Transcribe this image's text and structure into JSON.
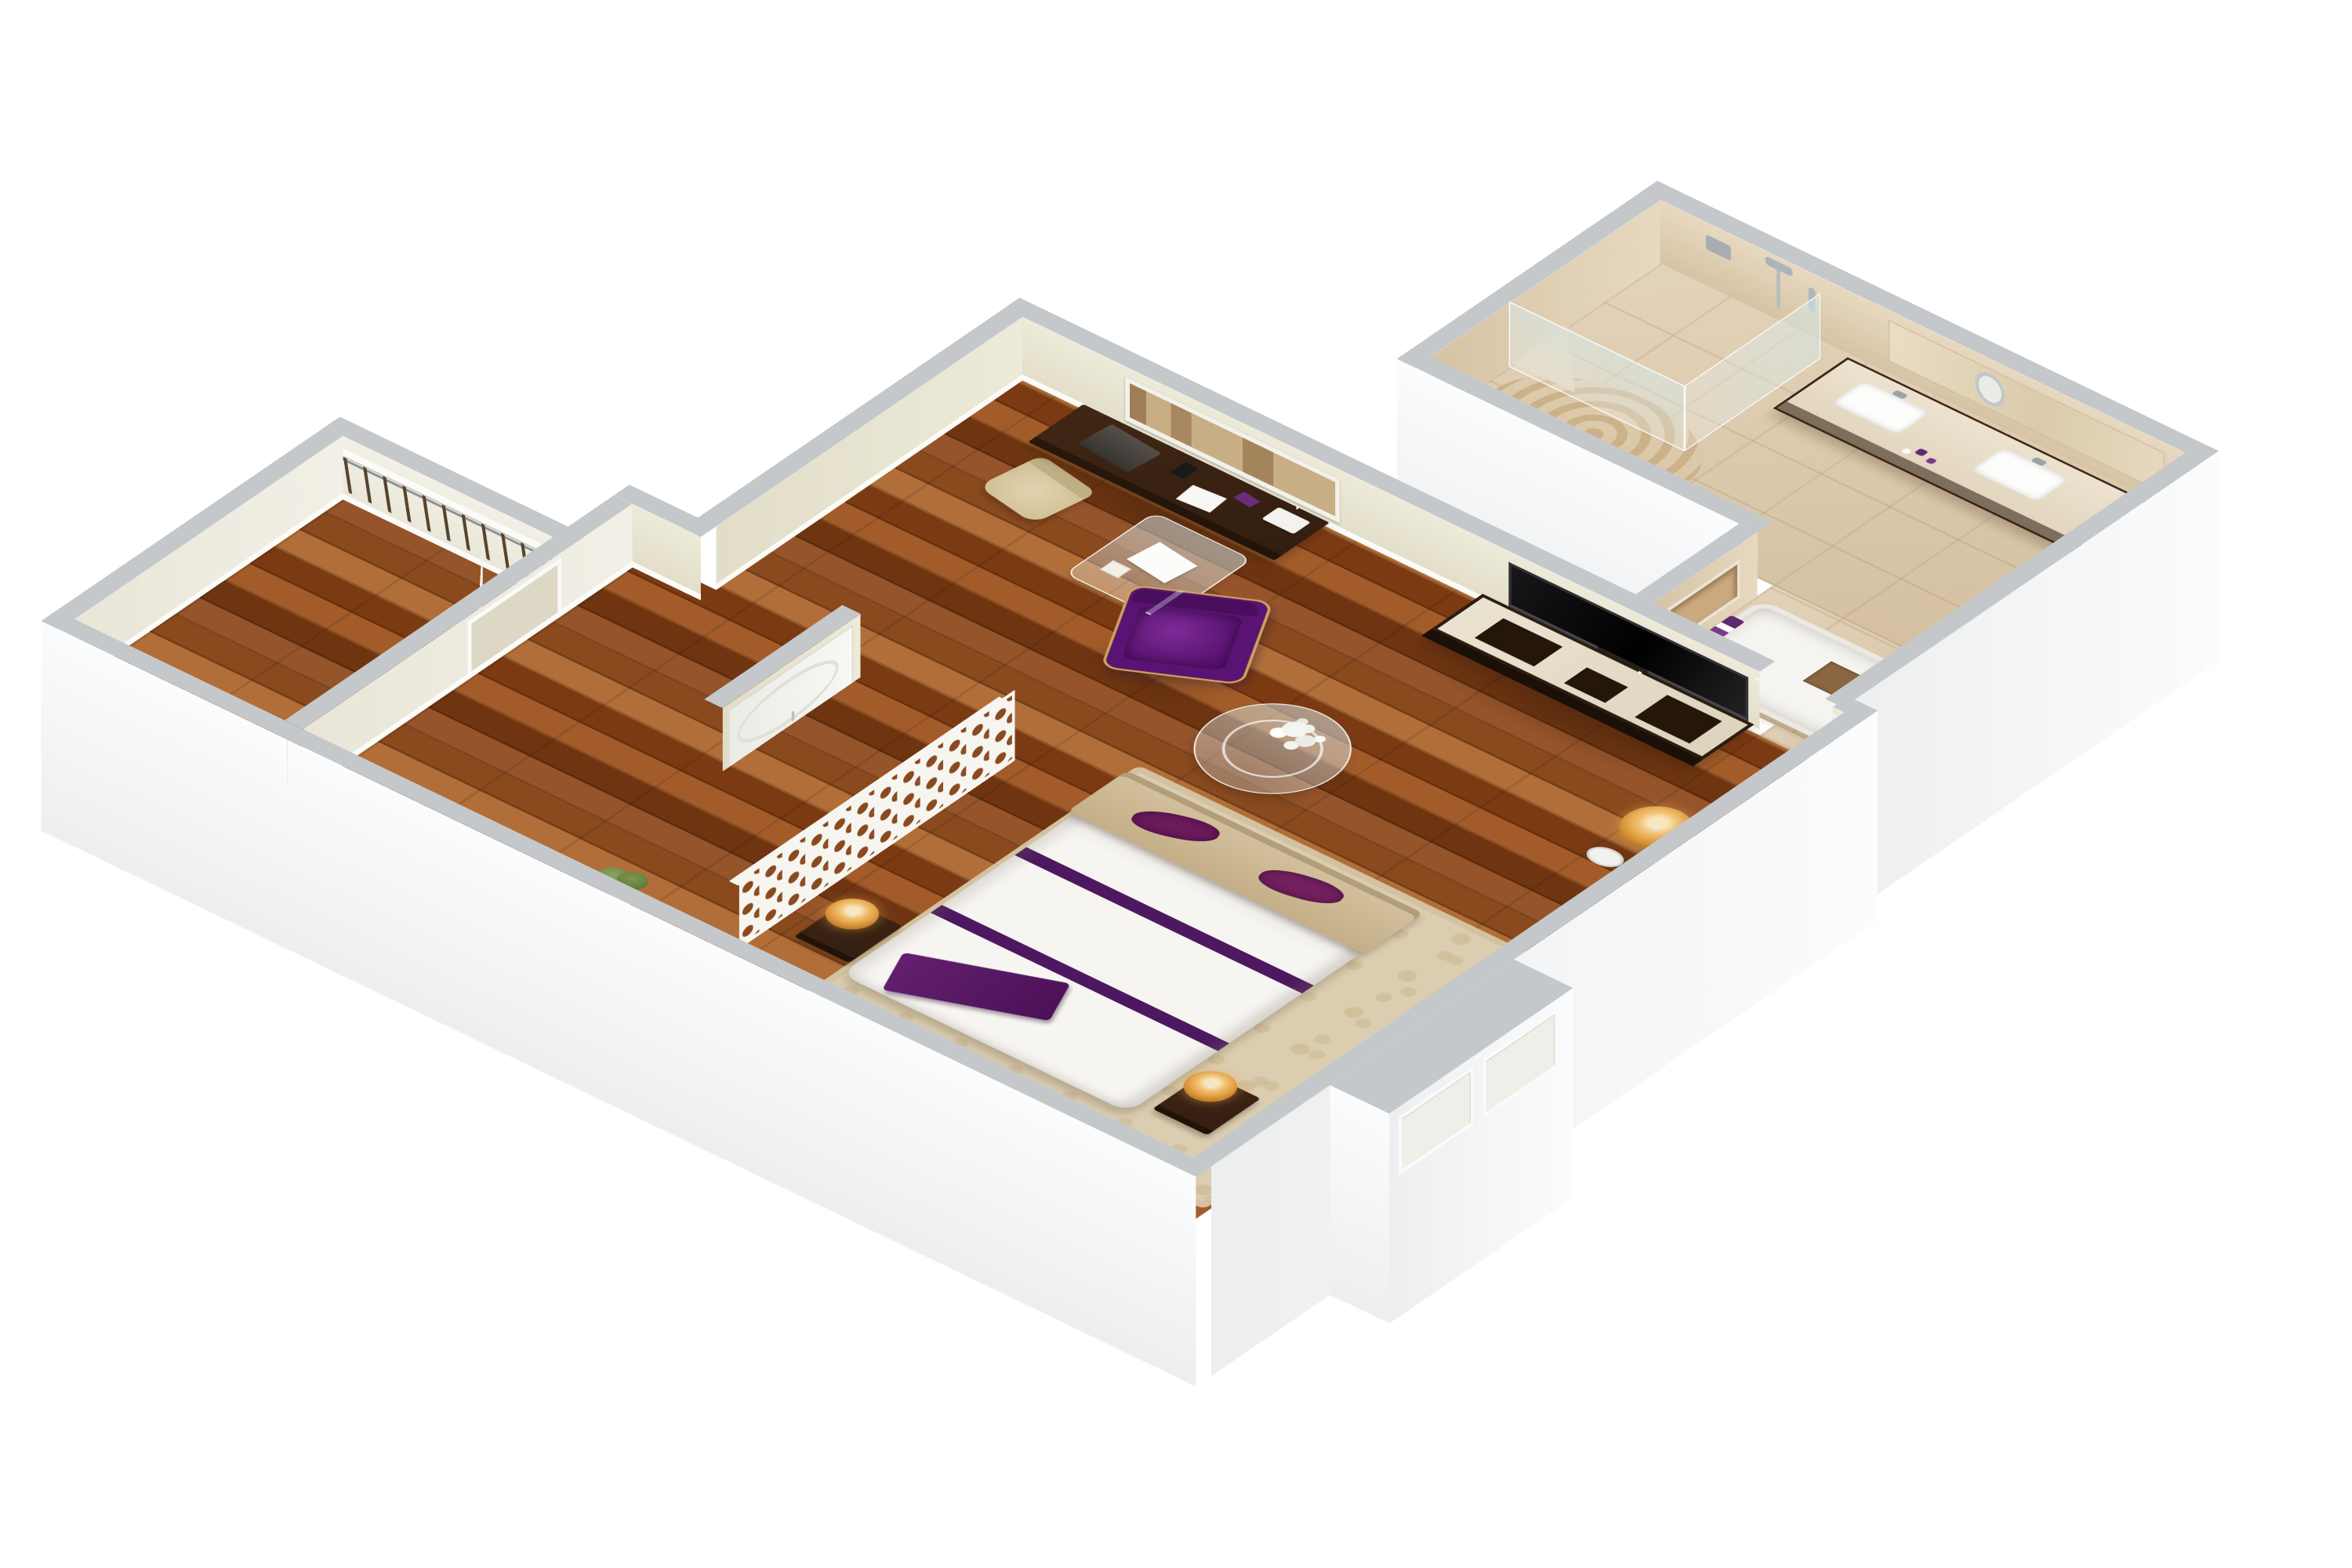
{
  "meta": {
    "title": "3D isometric floor plan — hotel guest suite",
    "view": "axonometric top-down render",
    "background": "#ffffff"
  },
  "palette": {
    "wall_cap_gray": "#c5c8cb",
    "wall_exterior_white": "#f7f8fa",
    "wall_interior_cream": "#e9e6d4",
    "wood_floor_brown": "#8d4a1e",
    "travertine_beige": "#dccaae",
    "accent_purple": "#5b1a68",
    "accent_gold": "#e0a14a",
    "rug_beige": "#dbcdb0",
    "duvet_white": "#f7f5f2",
    "furniture_dark_wood": "#3a2314"
  },
  "rooms": [
    {
      "id": "living_area",
      "label": "Living / work area",
      "floor": "dark wood planks",
      "items": [
        {
          "name": "writing-desk",
          "label": "Dark wood writing desk with laptop, phone, papers and tissue box"
        },
        {
          "name": "desk-chair",
          "label": "Beige upholstered desk chair"
        },
        {
          "name": "glass-side-table",
          "label": "Glass side table with white paper"
        },
        {
          "name": "framed-artwork",
          "label": "Framed sepia artwork on wall above desk"
        },
        {
          "name": "tv-console",
          "label": "Dark wood media console with travertine top"
        },
        {
          "name": "wall-tv",
          "label": "Large black flat-screen TV on wall"
        },
        {
          "name": "purple-armchair",
          "label": "Purple velvet armchair with gold trim"
        },
        {
          "name": "coffee-table",
          "label": "Round glass coffee table with white hydrangea centerpiece"
        },
        {
          "name": "floor-lamp",
          "label": "Floor lamp with amber drum shade and chrome pole"
        }
      ]
    },
    {
      "id": "bedroom",
      "label": "Bedroom",
      "floor": "dark wood planks with patterned beige area rug",
      "items": [
        {
          "name": "bed",
          "label": "Bed with white duvet and double purple band"
        },
        {
          "name": "headboard-bench",
          "label": "Beige upholstered headboard bench"
        },
        {
          "name": "purple-pillows",
          "label": "Two purple accent pillows"
        },
        {
          "name": "purple-runner",
          "label": "Purple throw at foot of bed"
        },
        {
          "name": "nightstands",
          "label": "Two dark wood nightstands with gold-shade table lamps"
        },
        {
          "name": "area-rug",
          "label": "Beige scroll-pattern area rug"
        },
        {
          "name": "lattice-divider",
          "label": "White decorative lattice room divider screen"
        },
        {
          "name": "oval-door",
          "label": "White interior door with oval moulding"
        },
        {
          "name": "potted-plant",
          "label": "Green potted plant in gold planter"
        }
      ]
    },
    {
      "id": "closet",
      "label": "Walk-in closet",
      "items": [
        {
          "name": "closet-shelf",
          "label": "White closet shelf"
        },
        {
          "name": "hanging-rod",
          "label": "Hanging rod with rows of dark hangers"
        },
        {
          "name": "closet-door",
          "label": "White closet door standing open"
        }
      ]
    },
    {
      "id": "bathroom",
      "label": "Bathroom",
      "floor": "travertine tile with round swirl rug",
      "items": [
        {
          "name": "walk-in-shower",
          "label": "Corner walk-in shower with glass panels"
        },
        {
          "name": "shower-bench",
          "label": "Corner shower bench"
        },
        {
          "name": "shower-fixtures",
          "label": "Wall-mounted shower fixtures"
        },
        {
          "name": "double-vanity",
          "label": "Dark wood double vanity with two white sinks"
        },
        {
          "name": "magnifying-mirror",
          "label": "Round magnifying mirror"
        },
        {
          "name": "wall-niche",
          "label": "Recessed wall niche"
        },
        {
          "name": "bathtub",
          "label": "Built-in bathtub with travertine deck and brown mat"
        },
        {
          "name": "toiletries",
          "label": "Purple toiletry bottles"
        }
      ]
    },
    {
      "id": "entry",
      "label": "Entry recess",
      "items": [
        {
          "name": "entry-door-frames",
          "label": "Two recessed white door frames on exterior wall"
        }
      ]
    }
  ]
}
